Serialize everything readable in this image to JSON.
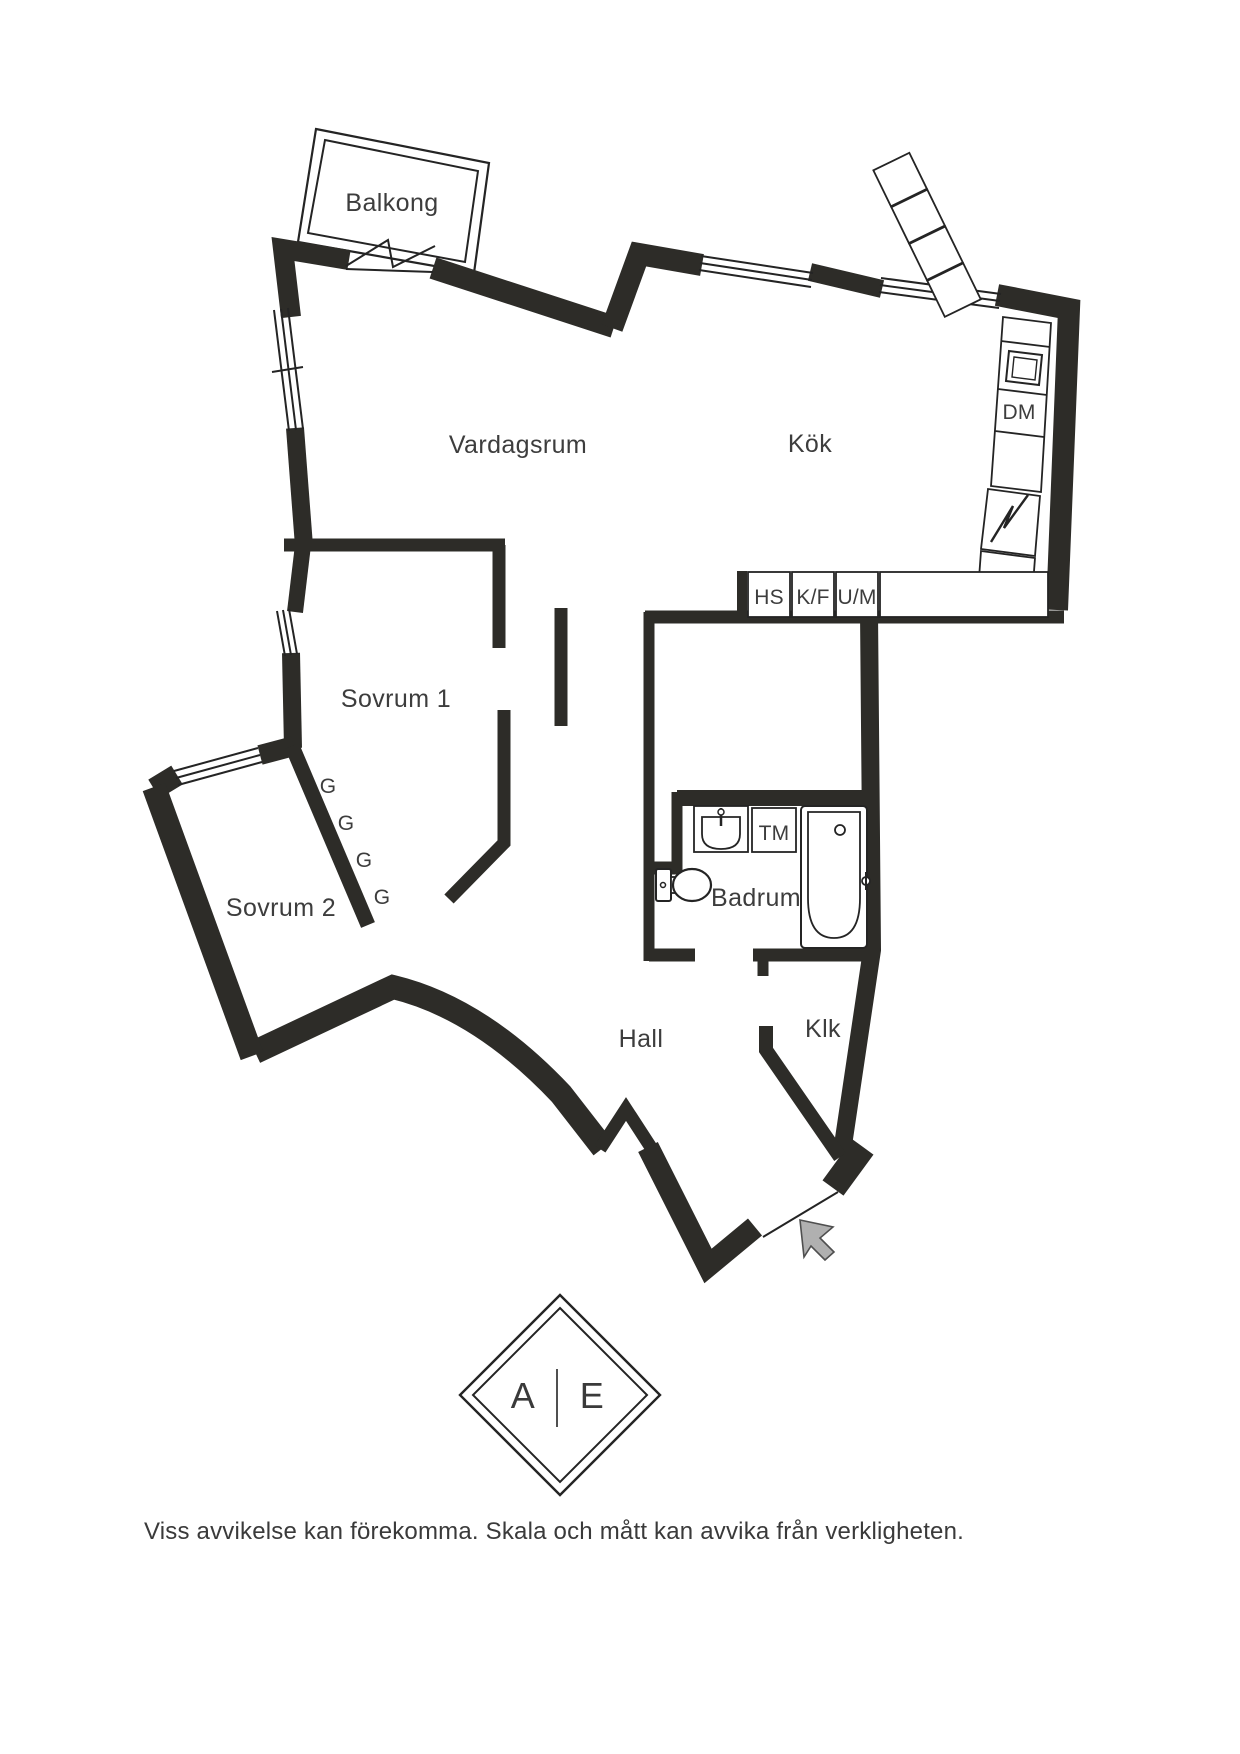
{
  "plan": {
    "rooms": {
      "balkong": "Balkong",
      "vardagsrum": "Vardagsrum",
      "kok": "Kök",
      "sovrum1": "Sovrum 1",
      "sovrum2": "Sovrum 2",
      "badrum": "Badrum",
      "hall": "Hall",
      "klk": "Klk"
    },
    "fixtures": {
      "dm": "DM",
      "hs": "HS",
      "kf": "K/F",
      "um": "U/M",
      "tm": "TM"
    },
    "wardrobes": [
      "G",
      "G",
      "G",
      "G"
    ]
  },
  "logo": {
    "left": "A",
    "right": "E"
  },
  "footer": {
    "disclaimer": "Viss avvikelse kan förekomma. Skala och mått kan avvika från verkligheten."
  },
  "colors": {
    "wall": "#2d2c28",
    "text": "#3d3d3d",
    "arrow_fill": "#b0b0b0",
    "background": "#ffffff"
  }
}
